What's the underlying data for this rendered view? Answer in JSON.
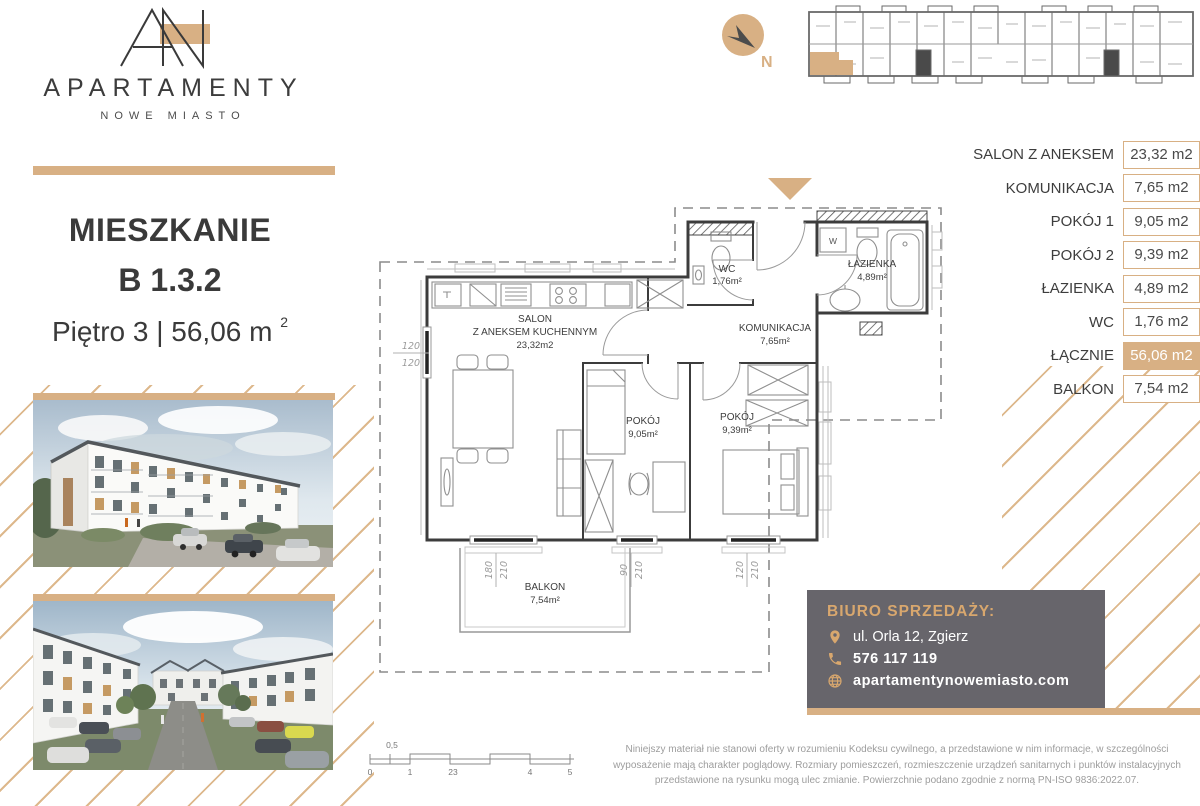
{
  "brand": {
    "name": "APARTAMENTY",
    "subtitle": "NOWE MIASTO"
  },
  "compass": {
    "label": "N"
  },
  "listing": {
    "type_label": "MIESZKANIE",
    "unit": "B 1.3.2",
    "floor_and_area": "Piętro 3 | 56,06 m",
    "area_sup": "2"
  },
  "rooms_table": {
    "rows": [
      {
        "label": "SALON Z ANEKSEM",
        "value": "23,32 m2"
      },
      {
        "label": "KOMUNIKACJA",
        "value": "7,65 m2"
      },
      {
        "label": "POKÓJ 1",
        "value": "9,05 m2"
      },
      {
        "label": "POKÓJ 2",
        "value": "9,39 m2"
      },
      {
        "label": "ŁAZIENKA",
        "value": "4,89 m2"
      },
      {
        "label": "WC",
        "value": "1,76 m2"
      },
      {
        "label": "ŁĄCZNIE",
        "value": "56,06 m2"
      },
      {
        "label": "BALKON",
        "value": "7,54 m2"
      }
    ]
  },
  "floor_plan": {
    "salon": {
      "line1": "SALON",
      "line2": "Z ANEKSEM KUCHENNYM",
      "area": "23,32m2"
    },
    "wc": {
      "name": "WC",
      "area": "1,76m²"
    },
    "lazienka": {
      "name": "ŁAZIENKA",
      "area": "4,89m²"
    },
    "komunikacja": {
      "name": "KOMUNIKACJA",
      "area": "7,65m²"
    },
    "pokoj1": {
      "name": "POKÓJ",
      "area": "9,05m²"
    },
    "pokoj2": {
      "name": "POKÓJ",
      "area": "9,39m²"
    },
    "balkon": {
      "name": "BALKON",
      "area": "7,54m²"
    },
    "washer": "W",
    "dims": {
      "left_window": {
        "a": "120",
        "b": "120"
      },
      "balcony_door": {
        "a": "180",
        "b": "210"
      },
      "window1": {
        "a": "90",
        "b": "210"
      },
      "window2": {
        "a": "120",
        "b": "210"
      }
    }
  },
  "scale_bar": {
    "half": "0,5",
    "zero": "0",
    "one": "1",
    "two_three": "23",
    "four": "4",
    "five": "5"
  },
  "sales_office": {
    "title": "BIURO SPRZEDAŻY:",
    "address": "ul. Orla 12, Zgierz",
    "phone": "576 117 119",
    "website": "apartamentynowemiasto.com"
  },
  "disclaimer": "Niniejszy materiał nie stanowi oferty w rozumieniu Kodeksu cywilnego, a przedstawione w nim informacje, w szczególności wyposażenie mają charakter poglądowy. Rozmiary pomieszczeń, rozmieszczenie urządzeń sanitarnych i punktów instalacyjnych przedstawione na rysunku mogą ulec zmianie. Powierzchnie podano zgodnie z normą PN-ISO 9836:2022.07.",
  "colors": {
    "accent": "#d8b084",
    "contact_bg": "#67656b",
    "highlight_text": "#ffffff"
  }
}
